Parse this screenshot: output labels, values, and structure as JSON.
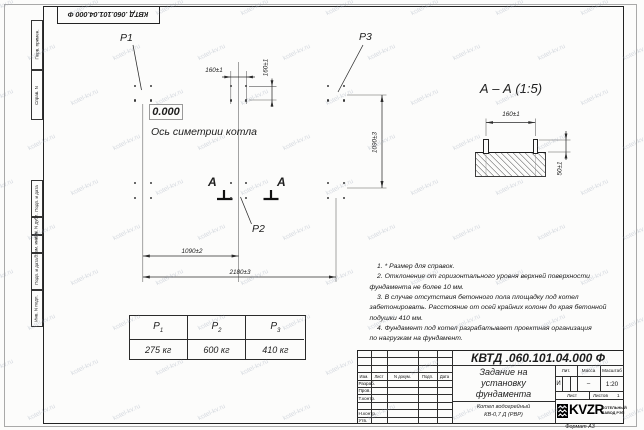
{
  "stamp_top": "КВТД .060.101.04.000 Ф",
  "watermark": {
    "text": "kotel-kv.ru"
  },
  "frame_left": {
    "labels": [
      "Перв. примен.",
      "Справ. N",
      "Подп. и дата",
      "Инв. N дубл.",
      "Взам. инв. N",
      "Подп. и дата",
      "Инв. N подл."
    ]
  },
  "plan": {
    "labels": {
      "p1": "P1",
      "p2": "P2",
      "p3": "P3"
    },
    "elevation": "0.000",
    "axis_caption": "Ось симетрии котла",
    "section_letter": "А",
    "dims": {
      "bolt_pitch_h": "160±1",
      "bolt_pitch_v": "160±1",
      "half_span": "1090±2",
      "full_span": "2180±3",
      "depth": "1090±3"
    },
    "bolt_groups": [
      [
        142.8,
        93.3
      ],
      [
        238.6,
        93.3
      ],
      [
        336,
        93.3
      ],
      [
        142.8,
        190.4
      ],
      [
        238.6,
        190.4
      ],
      [
        336,
        190.4
      ]
    ],
    "bolt_dx": 7.8,
    "bolt_dy": 7.2
  },
  "section_view": {
    "title": "А – А (1:5)",
    "dim_pitch": "160±1",
    "dim_height": "50±1"
  },
  "notes": [
    "    1. * Размер для справок.",
    "    2. Отклонение от горизонтального уровня верхней поверхности",
    "фундамента не более 10 мм.",
    "    3. В случае отсутствия бетонного пола площадку под котел",
    "забетонировать. Расстояние от осей крайних колонн до края бетонной",
    "подушки 410 мм.",
    "    4. Фундамент под котел разрабатывает проектная организация",
    "по нагрузкам на фундамент."
  ],
  "load_table": {
    "headers": [
      {
        "label": "P",
        "sub": "1"
      },
      {
        "label": "P",
        "sub": "2"
      },
      {
        "label": "P",
        "sub": "3"
      }
    ],
    "values": [
      "275 кг",
      "600 кг",
      "410 кг"
    ]
  },
  "title_block": {
    "doc_number": "КВТД .060.101.04.000 Ф",
    "title_lines": [
      "Задание на",
      "установку",
      "фундамента"
    ],
    "product_lines": [
      "Котел водогрейный",
      "КВ-0,7 Д (РВР)"
    ],
    "header_cols": [
      "Изм.",
      "Лист",
      "N докум.",
      "Подп.",
      "Дата"
    ],
    "row_labels": [
      "Разраб.",
      "Пров.",
      "Т.контр.",
      "",
      "Н.контр.",
      "Утв."
    ],
    "lit_label": "Лит.",
    "mass_label": "Масса",
    "scale_label": "Масштаб",
    "lit_value": "И",
    "mass_value": "–",
    "scale_value": "1:20",
    "sheet_label": "Лист",
    "sheets_label": "Листов",
    "sheets_value": "1",
    "logo_text": "KVZR",
    "logo_sub1": "КОТЕЛЬНЫЙ",
    "logo_sub2": "ЗАВОД РЭП",
    "format_label": "Формат А3"
  }
}
